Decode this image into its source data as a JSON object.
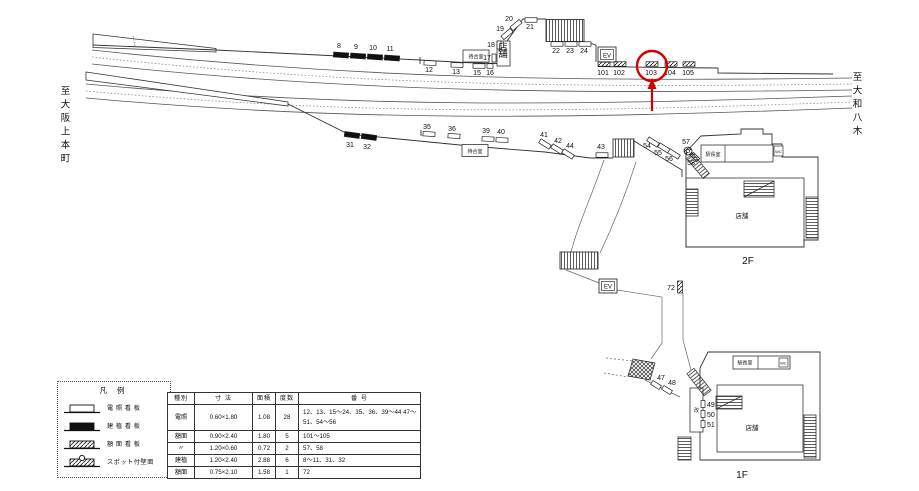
{
  "directions": {
    "left": "至大阪上本町",
    "right": "至大和八木"
  },
  "floors": {
    "upper": "2F",
    "lower": "1F"
  },
  "facilities": {
    "waiting_room": "待合室",
    "kiosk": "店舗",
    "store": "店舗",
    "office": "駅長室",
    "wc": "WC",
    "elevator": "EV",
    "gate": "改"
  },
  "highlight": {
    "number": "103",
    "color": "#d40000"
  },
  "legend": {
    "title": "凡 例",
    "items": [
      {
        "type": "densho",
        "label": "電 照 看 板"
      },
      {
        "type": "kenshoku",
        "label": "建 植 看 板"
      },
      {
        "type": "gakumen",
        "label": "額 面 看 板"
      },
      {
        "type": "spot",
        "label": "スポット付壁面"
      }
    ]
  },
  "table": {
    "headers": [
      "種別",
      "寸 法",
      "面積",
      "度数",
      "番 号"
    ],
    "rows": [
      {
        "kind": "電照",
        "size": "0.60×1.80",
        "area": "1.08",
        "count": "28",
        "numbers": "12、13、15〜24、35、36、39〜44 47〜51、54〜56"
      },
      {
        "kind": "額面",
        "size": "0.90×2.40",
        "area": "1.80",
        "count": "5",
        "numbers": "101〜105"
      },
      {
        "kind": "〃",
        "size": "1.20×0.60",
        "area": "0.72",
        "count": "2",
        "numbers": "57、58"
      },
      {
        "kind": "建植",
        "size": "1.20×2.40",
        "area": "2.88",
        "count": "6",
        "numbers": "8〜11、31、32"
      },
      {
        "kind": "額面",
        "size": "0.75×2.10",
        "area": "1.58",
        "count": "1",
        "numbers": "72"
      }
    ]
  },
  "markers": [
    {
      "n": "8",
      "t": "k",
      "x": 341,
      "y": 55,
      "rot": 4,
      "lx": 339,
      "ly": 48
    },
    {
      "n": "9",
      "t": "k",
      "x": 358,
      "y": 56,
      "rot": 4,
      "lx": 356,
      "ly": 49
    },
    {
      "n": "10",
      "t": "k",
      "x": 375,
      "y": 57,
      "rot": 4,
      "lx": 373,
      "ly": 50
    },
    {
      "n": "11",
      "t": "k",
      "x": 392,
      "y": 58,
      "rot": 4,
      "lx": 390,
      "ly": 51
    },
    {
      "n": "12",
      "t": "d",
      "x": 430,
      "y": 63,
      "rot": 3,
      "lx": 429,
      "ly": 72
    },
    {
      "n": "13",
      "t": "d",
      "x": 457,
      "y": 65,
      "rot": 2,
      "lx": 456,
      "ly": 74
    },
    {
      "n": "15",
      "t": "d",
      "x": 479,
      "y": 66,
      "lx": 477,
      "ly": 75
    },
    {
      "n": "16",
      "t": "d",
      "x": 490,
      "y": 66,
      "w": 6,
      "lx": 490,
      "ly": 75
    },
    {
      "n": "17",
      "t": "d",
      "x": 494,
      "y": 58,
      "w": 4,
      "h": 8,
      "lx": 487,
      "ly": 60
    },
    {
      "n": "18",
      "t": "d",
      "x": 499,
      "y": 45,
      "w": 4,
      "h": 8,
      "lx": 491,
      "ly": 47
    },
    {
      "n": "19",
      "t": "d",
      "x": 507,
      "y": 34,
      "rot": -40,
      "lx": 500,
      "ly": 31
    },
    {
      "n": "20",
      "t": "d",
      "x": 516,
      "y": 25,
      "rot": -40,
      "lx": 509,
      "ly": 21
    },
    {
      "n": "21",
      "t": "d",
      "x": 531,
      "y": 20,
      "lx": 530,
      "ly": 29
    },
    {
      "n": "22",
      "t": "d",
      "x": 557,
      "y": 44,
      "lx": 556,
      "ly": 53
    },
    {
      "n": "23",
      "t": "d",
      "x": 571,
      "y": 44,
      "lx": 570,
      "ly": 53
    },
    {
      "n": "24",
      "t": "d",
      "x": 585,
      "y": 44,
      "lx": 584,
      "ly": 53
    },
    {
      "n": "101",
      "t": "g",
      "x": 604,
      "y": 64,
      "lx": 603,
      "ly": 75
    },
    {
      "n": "102",
      "t": "g",
      "x": 620,
      "y": 64,
      "lx": 619,
      "ly": 75
    },
    {
      "n": "103",
      "t": "g",
      "x": 652,
      "y": 64,
      "lx": 651,
      "ly": 75
    },
    {
      "n": "104",
      "t": "g",
      "x": 671,
      "y": 64,
      "lx": 670,
      "ly": 75
    },
    {
      "n": "105",
      "t": "g",
      "x": 689,
      "y": 64,
      "lx": 688,
      "ly": 75
    },
    {
      "n": "31",
      "t": "k",
      "x": 352,
      "y": 135,
      "rot": 8,
      "lx": 350,
      "ly": 147
    },
    {
      "n": "32",
      "t": "k",
      "x": 369,
      "y": 137,
      "rot": 8,
      "lx": 367,
      "ly": 149
    },
    {
      "n": "35",
      "t": "d",
      "x": 429,
      "y": 134,
      "rot": 4,
      "lx": 427,
      "ly": 129
    },
    {
      "n": "36",
      "t": "d",
      "x": 454,
      "y": 136,
      "rot": 4,
      "lx": 452,
      "ly": 131
    },
    {
      "n": "39",
      "t": "d",
      "x": 488,
      "y": 139,
      "rot": 3,
      "lx": 486,
      "ly": 133
    },
    {
      "n": "40",
      "t": "d",
      "x": 502,
      "y": 140,
      "rot": 3,
      "lx": 501,
      "ly": 134
    },
    {
      "n": "41",
      "t": "d",
      "x": 545,
      "y": 144,
      "rot": 32,
      "lx": 544,
      "ly": 137
    },
    {
      "n": "42",
      "t": "d",
      "x": 557,
      "y": 149,
      "rot": 32,
      "lx": 558,
      "ly": 143
    },
    {
      "n": "44",
      "t": "d",
      "x": 568,
      "y": 154,
      "rot": 32,
      "lx": 570,
      "ly": 148
    },
    {
      "n": "43",
      "t": "d",
      "x": 602,
      "y": 155,
      "lx": 601,
      "ly": 149
    },
    {
      "n": "54",
      "t": "d",
      "x": 653,
      "y": 142,
      "rot": 32,
      "lx": 647,
      "ly": 148
    },
    {
      "n": "55",
      "t": "d",
      "x": 664,
      "y": 148,
      "rot": 32,
      "lx": 658,
      "ly": 155
    },
    {
      "n": "56",
      "t": "d",
      "x": 674,
      "y": 154,
      "rot": 32,
      "lx": 669,
      "ly": 161
    },
    {
      "n": "57",
      "t": "s",
      "x": 688,
      "y": 151,
      "lx": 686,
      "ly": 144
    },
    {
      "n": "58",
      "t": "g",
      "x": 695,
      "y": 157,
      "w": 9,
      "rot": 45,
      "lx": 691,
      "ly": 165
    },
    {
      "n": "72",
      "t": "g",
      "x": 680,
      "y": 287,
      "w": 5,
      "h": 12,
      "lx": 671,
      "ly": 290
    },
    {
      "n": "47",
      "t": "d",
      "x": 656,
      "y": 385,
      "w": 10,
      "rot": 32,
      "lx": 661,
      "ly": 380
    },
    {
      "n": "48",
      "t": "d",
      "x": 667,
      "y": 390,
      "w": 10,
      "rot": 32,
      "lx": 672,
      "ly": 385
    },
    {
      "n": "49",
      "t": "d",
      "x": 703,
      "y": 404,
      "w": 4,
      "h": 7,
      "lx": 707,
      "ly": 407,
      "a": "s"
    },
    {
      "n": "50",
      "t": "d",
      "x": 703,
      "y": 414,
      "w": 4,
      "h": 7,
      "lx": 707,
      "ly": 417,
      "a": "s"
    },
    {
      "n": "51",
      "t": "d",
      "x": 703,
      "y": 424,
      "w": 4,
      "h": 7,
      "lx": 707,
      "ly": 427,
      "a": "s"
    }
  ]
}
